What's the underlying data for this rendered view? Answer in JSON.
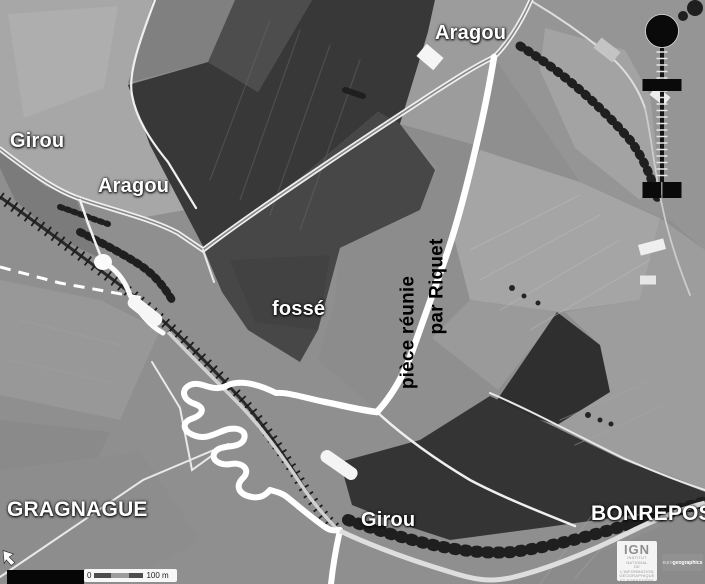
{
  "map": {
    "labels": {
      "aragou_top": "Aragou",
      "girou_upper": "Girou",
      "aragou_left": "Aragou",
      "fosse": "fossé",
      "piece_reunie": "pièce réunie",
      "par_riquet": "par Riquet",
      "gragnague": "GRAGNAGUE",
      "girou_lower": "Girou",
      "bonrepos": "BONREPOS"
    },
    "scale_bar": {
      "zero": "0",
      "label": "100 m"
    },
    "logos": {
      "ign": {
        "name": "IGN",
        "lines": [
          "INSTITUT NATIONAL",
          "DE L'INFORMATION",
          "GÉOGRAPHIQUE",
          "ET FORESTIÈRE"
        ]
      },
      "eurogeographics": {
        "prefix": "euro",
        "suffix": "geographics"
      }
    },
    "symbols": {
      "circle_marker": "filled-black-circle",
      "ladder_line": "vertical-tick-line",
      "bar_marker": "black-horizontal-bar",
      "square_markers": "black-square-pair",
      "north_west_arrow": "white-arrow-icon"
    },
    "colors": {
      "overlay_line": "#ffffff",
      "label_light": "#ffffff",
      "label_dark": "#000000",
      "marker_black": "#0a0a0a",
      "photo_dark_field": "#383838",
      "photo_light_field": "#a7a7a7"
    }
  }
}
